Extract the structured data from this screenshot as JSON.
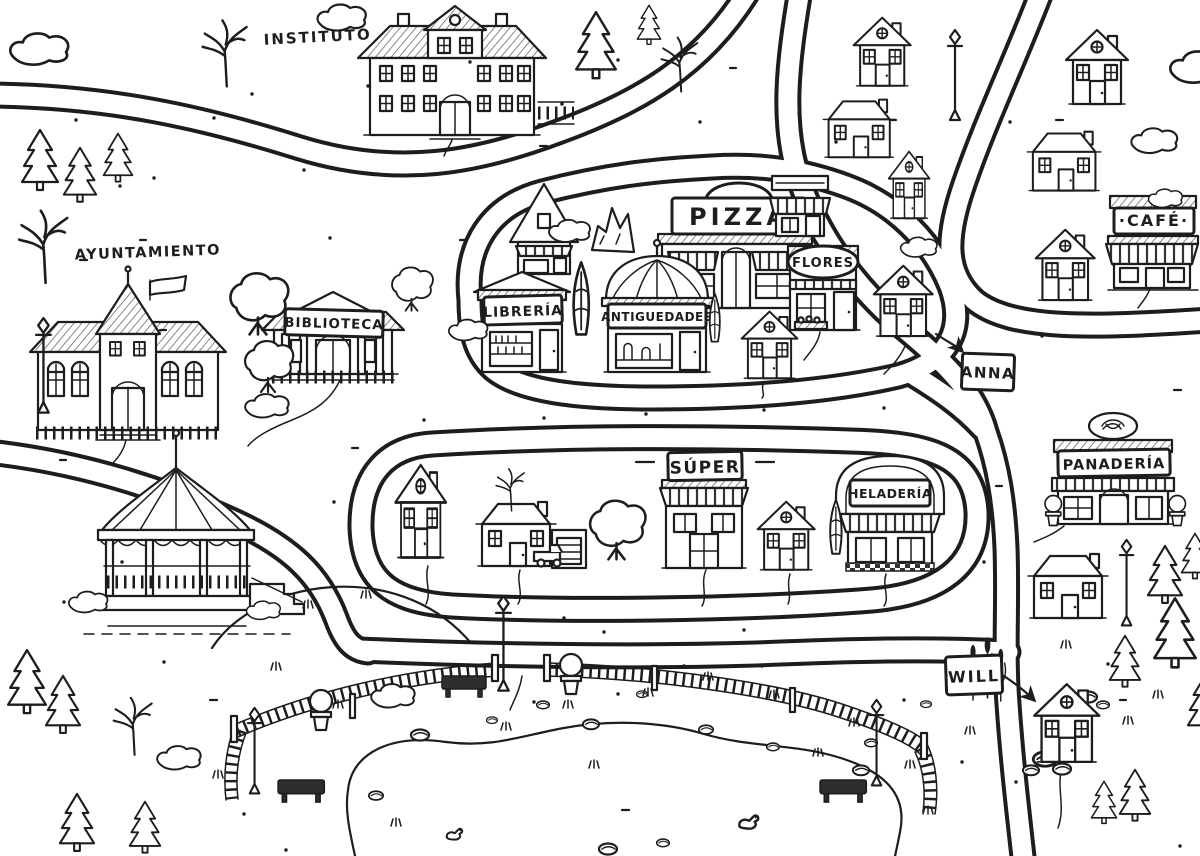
{
  "map": {
    "kind": "hand-drawn-town-map",
    "colors": {
      "ink": "#1d1d1d",
      "paper": "#ffffff"
    },
    "labels": {
      "instituto": "INSTITUTO",
      "ayuntamiento": "AYUNTAMIENTO",
      "biblioteca": "BIBLIOTECA",
      "pizza": "PIZZA",
      "libreria": "LIBRERÍA",
      "antiguedades": "ANTIGUEDADES",
      "flores": "FLORES",
      "cafe": "·CAFÉ·",
      "anna": "ANNA",
      "super": "SÚPER",
      "heladeria": "HELADERÍA",
      "panaderia": "PANADERÍA",
      "will": "WILL"
    },
    "features": [
      "high-school",
      "town-hall",
      "library",
      "pizzeria",
      "bookstore",
      "antiques-shop",
      "flower-shop",
      "cafe",
      "supermarket",
      "ice-cream-shop",
      "bakery",
      "resident-tag-anna",
      "resident-tag-will",
      "gazebo",
      "park",
      "pond",
      "picket-fence",
      "benches",
      "street-lamps",
      "topiaries",
      "pine-trees",
      "houses",
      "roads"
    ]
  }
}
